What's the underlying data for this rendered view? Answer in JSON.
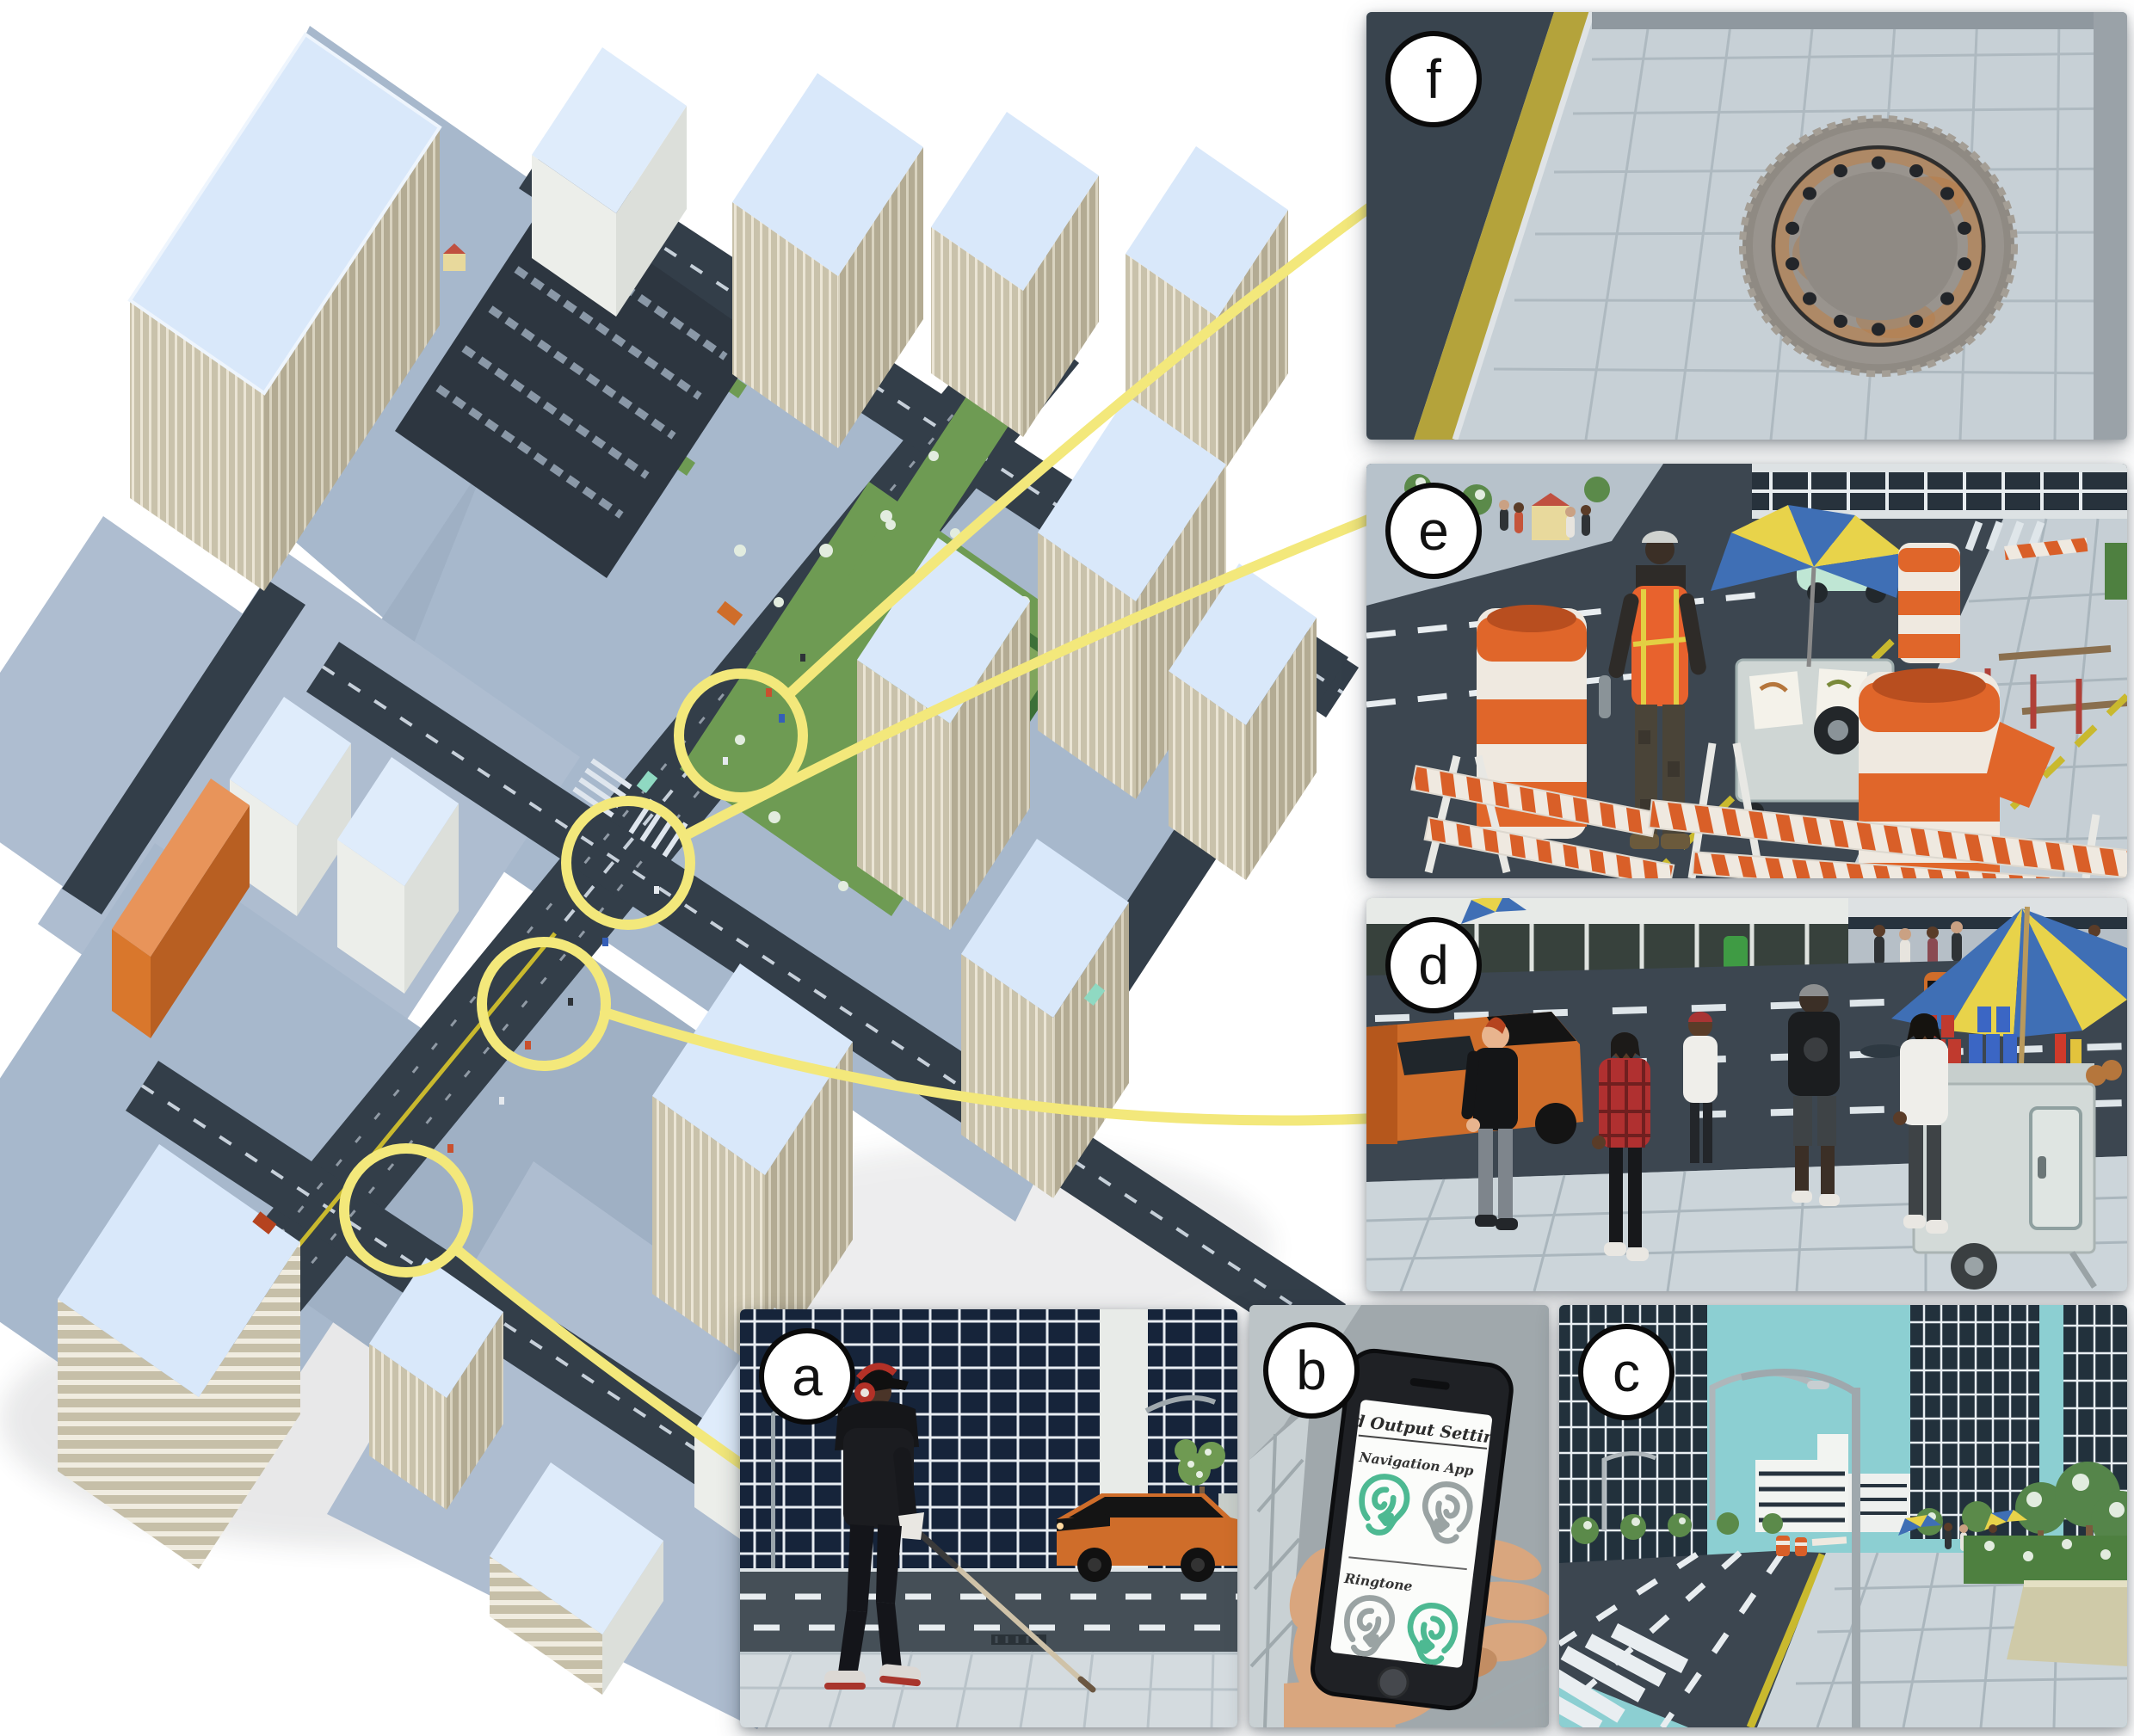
{
  "figure": {
    "kind": "virtual-city simulation overview with six callout views"
  },
  "panels": {
    "a": {
      "label": "a"
    },
    "b": {
      "label": "b",
      "phone": {
        "title": "Sound Output Setting",
        "nav_label": "Navigation App",
        "ringtone_label": "Ringtone"
      }
    },
    "c": {
      "label": "c"
    },
    "d": {
      "label": "d"
    },
    "e": {
      "label": "e"
    },
    "f": {
      "label": "f"
    }
  },
  "colors": {
    "callout_yellow": "#f3e87b",
    "sky_teal": "#8ccfd2",
    "construction_orange": "#d95f28",
    "safety_vest_orange": "#e8622d",
    "taxi_orange": "#cf6d2a",
    "ear_active_green": "#4db992",
    "ear_inactive_gray": "#9aa3a3"
  }
}
